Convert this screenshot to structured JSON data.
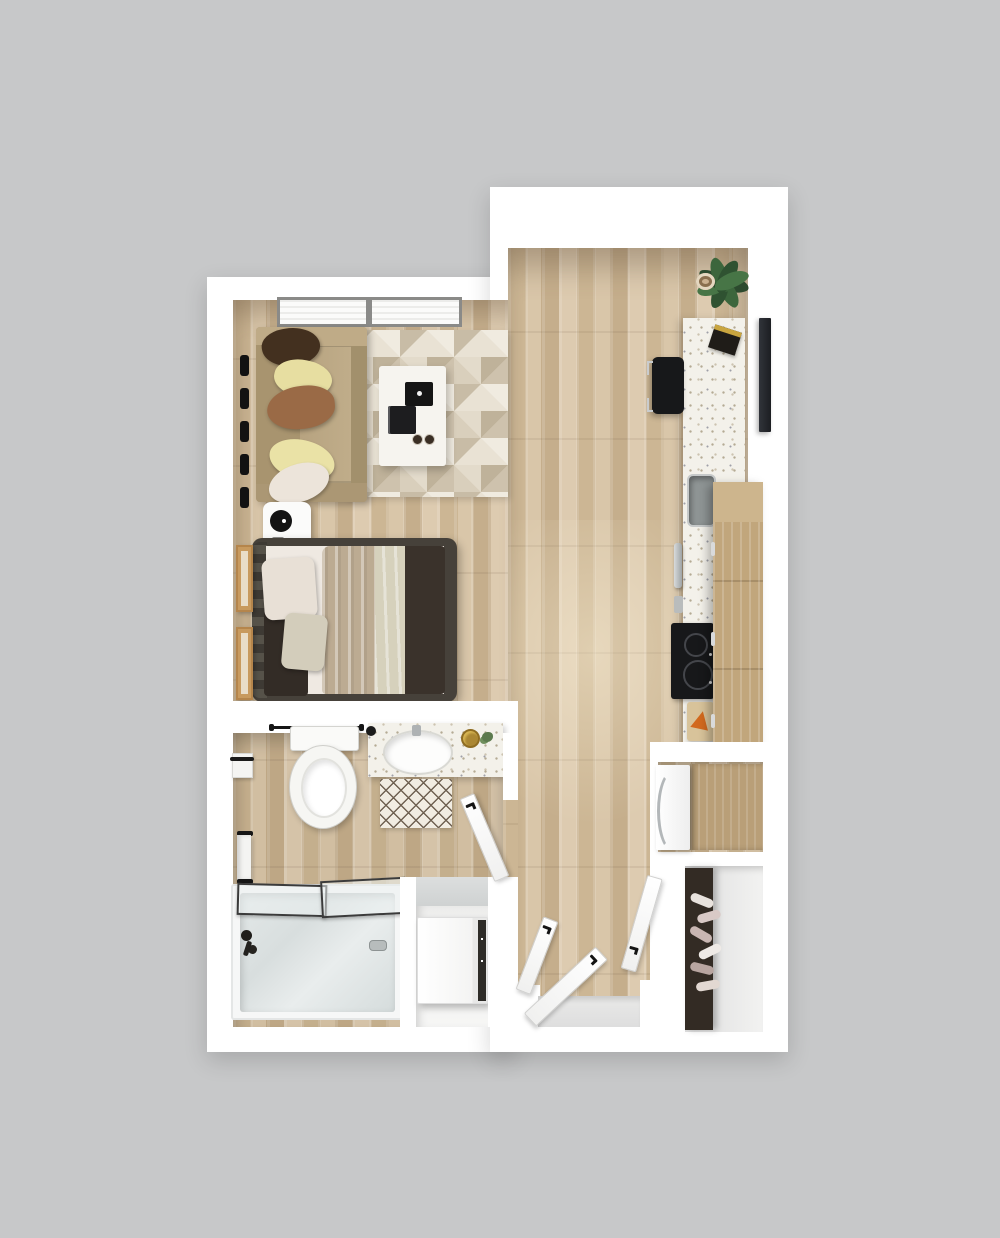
{
  "scene": {
    "type": "3d-floor-plan-top-view",
    "description": "Studio apartment 3D floor plan, top-down render, no text labels",
    "background_color": "#c7c8c9",
    "wall_color": "#ffffff"
  },
  "palette": {
    "wood_floor": "#d2bea0",
    "wood_plank_dark": "#c5ae8c",
    "wood_plank_light": "#ddcbb0",
    "terrazzo_counter": "#f3f1ea",
    "sofa_tan": "#b19d7b",
    "pillow_dark_brown": "#43301f",
    "pillow_yellow": "#e7dea1",
    "pillow_caramel": "#9a6a46",
    "pillow_cream": "#ece4da",
    "bed_frame_dark": "#46413a",
    "blanket_tan": "#bcab92",
    "blanket_dark_brown": "#3a322b",
    "tub_gray": "#dce1e1",
    "appliance_black": "#1a1b1d",
    "plant_green": "#2f5231",
    "accent_gold": "#b8902f",
    "rug_base": "#e9e2d4",
    "rug_triangle": "#bfb29a"
  },
  "rooms": {
    "living": "living-sleeping-area",
    "kitchen": "kitchen-and-hall",
    "bathroom": "bathroom",
    "laundry": "laundry-nook",
    "closet": "entry-closet",
    "entry": "entry"
  },
  "furniture": {
    "sofa": "fabric-sofa-with-pillows",
    "rug": "geometric-triangle-rug",
    "coffee_table": "white-coffee-table",
    "laptop": "black-laptop",
    "cups": "two-coffee-cups",
    "fan": "table-fan-on-nightstand",
    "bed": "upholstered-bed-with-layered-bedding",
    "wall_art": "two-framed-artworks",
    "window": "living-room-window",
    "blinds": "window-blind-hardware",
    "tv": "wall-mounted-tv",
    "counter": "terrazzo-kitchen-counter",
    "stool": "black-bar-stool",
    "book": "book-on-counter",
    "plant": "potted-fiddle-leaf-plant",
    "sink_kitchen": "kitchen-sink",
    "faucet_kitchen": "kitchen-faucet",
    "cooktop": "two-burner-cooktop",
    "cutting_board": "cutting-board-with-food",
    "cabinets": "wood-upper-cabinets",
    "fridge": "refrigerator",
    "toilet": "toilet",
    "vanity": "terrazzo-vanity-with-sink",
    "mat": "diamond-pattern-bath-mat",
    "towel": "hand-towel-on-rail",
    "tp_holder": "toilet-paper-holder",
    "towel_bar": "towel-bar",
    "tub": "bathtub-with-glass-screen",
    "tub_faucet": "bathtub-faucet",
    "washer": "washer-dryer",
    "shoe_rack": "shoe-rack-with-shoes",
    "doors": "open-white-doors",
    "threshold": "entry-threshold"
  }
}
